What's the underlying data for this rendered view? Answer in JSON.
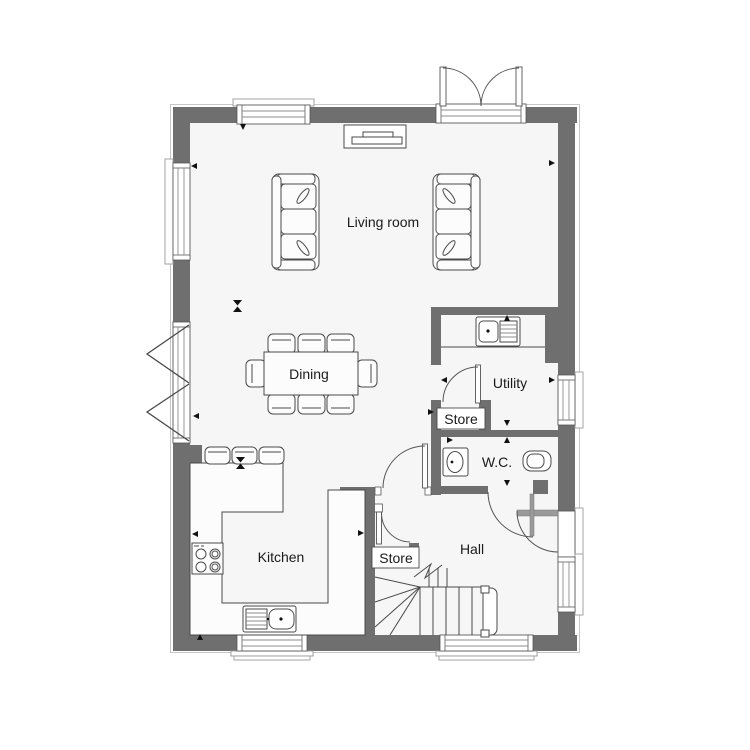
{
  "plan": {
    "rooms": {
      "living": {
        "label": "Living room"
      },
      "dining": {
        "label": "Dining"
      },
      "utility": {
        "label": "Utility"
      },
      "store_utility": {
        "label": "Store"
      },
      "wc": {
        "label": "W.C."
      },
      "kitchen": {
        "label": "Kitchen"
      },
      "store_hall": {
        "label": "Store"
      },
      "hall": {
        "label": "Hall"
      }
    },
    "colors": {
      "paper": "#ffffff",
      "floor": "#f6f6f6",
      "wall": "#6f6f6f",
      "outline": "#4a4a4a",
      "light": "#9a9a9a",
      "text": "#1a1a1a"
    },
    "furniture": [
      {
        "name": "sofa",
        "count": 2
      },
      {
        "name": "tv-unit",
        "count": 1
      },
      {
        "name": "dining-table",
        "count": 1
      },
      {
        "name": "dining-chair",
        "count": 8
      },
      {
        "name": "bar-stool",
        "count": 3
      },
      {
        "name": "kitchen-counter",
        "count": 1
      },
      {
        "name": "hob",
        "count": 1
      },
      {
        "name": "kitchen-sink",
        "count": 1
      },
      {
        "name": "utility-sink",
        "count": 1
      },
      {
        "name": "wash-basin",
        "count": 1
      },
      {
        "name": "toilet",
        "count": 1
      },
      {
        "name": "staircase",
        "count": 1
      }
    ]
  }
}
